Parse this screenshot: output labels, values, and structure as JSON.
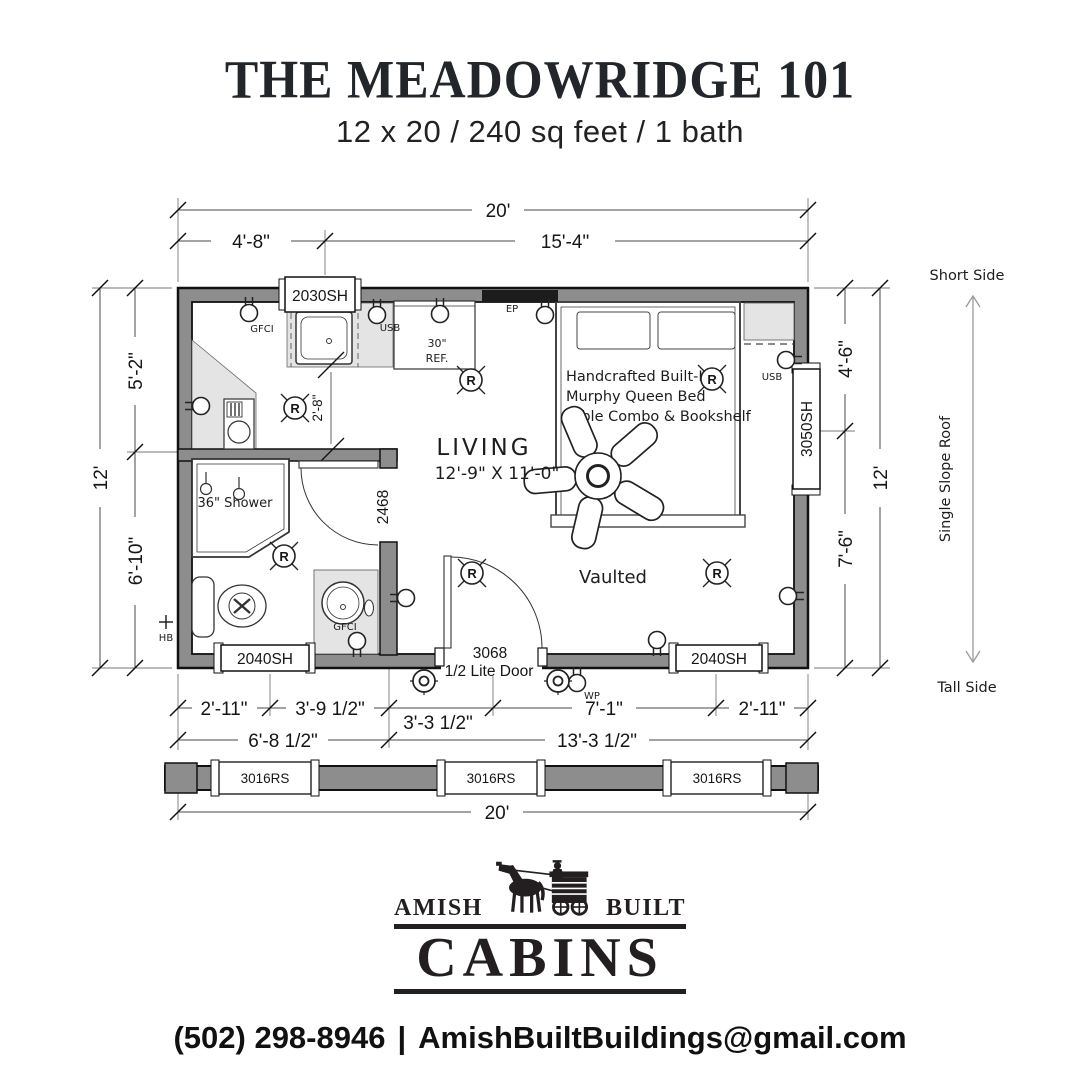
{
  "header": {
    "title": "THE MEADOWRIDGE 101",
    "subtitle": "12 x 20 / 240 sq feet / 1 bath"
  },
  "dimensions": {
    "top": {
      "total": "20'",
      "left_segment": "4'-8\"",
      "right_segment": "15'-4\""
    },
    "left": {
      "upper": "5'-2\"",
      "total": "12'",
      "lower": "6'-10\""
    },
    "right": {
      "upper": "4'-6\"",
      "total": "12'",
      "lower": "7'-6\""
    },
    "bottom": {
      "row1": [
        "2'-11\"",
        "3'-9 1/2\"",
        "3'-3 1/2\"",
        "7'-1\"",
        "2'-11\""
      ],
      "row2": [
        "6'-8 1/2\"",
        "13'-3 1/2\""
      ],
      "elevation_total": "20'"
    },
    "kitchen_counter": "2'-8\""
  },
  "windows": {
    "top": "2030SH",
    "right": "3050SH",
    "bottom_left": "2040SH",
    "bottom_right": "2040SH",
    "tall_side": [
      "3016RS",
      "3016RS",
      "3016RS"
    ]
  },
  "doors": {
    "bath": "2468",
    "entry_size": "3068",
    "entry_type": "1/2 Lite Door"
  },
  "rooms": {
    "living": {
      "name": "LIVING",
      "size": "12'-9\" X 11'-0\"",
      "ceiling": "Vaulted"
    },
    "bath": {
      "shower": "36\" Shower"
    },
    "kitchen": {
      "fridge_width": "30\"",
      "fridge": "REF."
    },
    "bed": {
      "line1": "Handcrafted Built-In",
      "line2": "Murphy Queen Bed",
      "line3": "Table Combo & Bookshelf"
    }
  },
  "electrical": {
    "gfci": "GFCI",
    "usb_kitchen": "USB",
    "panel": "EP",
    "usb_bedroom": "USB",
    "weatherproof": "WP",
    "hose_bib": "HB",
    "recessed": "R"
  },
  "roof": {
    "short_side": "Short Side",
    "slope": "Single Slope Roof",
    "tall_side": "Tall Side"
  },
  "logo": {
    "amish": "AMISH",
    "built": "BUILT",
    "cabins": "CABINS"
  },
  "contact": {
    "phone": "(502) 298-8946",
    "separator": "|",
    "email": "AmishBuiltBuildings@gmail.com"
  },
  "colors": {
    "wall": "#8d8d8d",
    "counter": "#e4e4e4",
    "ink": "#1d1d1d"
  }
}
